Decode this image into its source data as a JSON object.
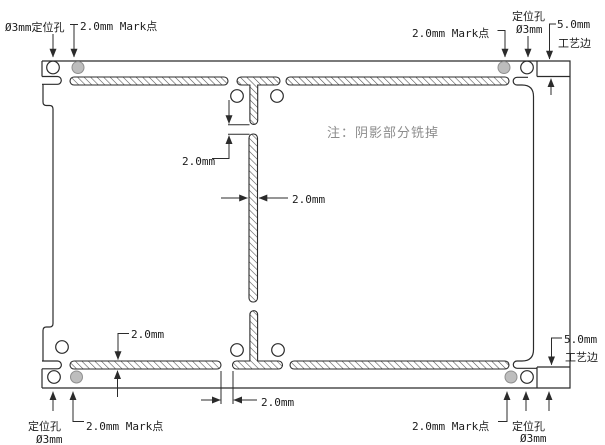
{
  "drawing": {
    "note": "注：阴影部分铣掉",
    "annotations": {
      "top_left_hole": "Ø3mm定位孔",
      "top_left_mark": "2.0mm Mark点",
      "top_right_mark": "2.0mm Mark点",
      "top_right_hole": [
        "定位孔",
        "Ø3mm"
      ],
      "top_right_edge": [
        "5.0mm",
        "工艺边"
      ],
      "bottom_left_hole": [
        "定位孔",
        "Ø3mm"
      ],
      "bottom_left_mark": "2.0mm Mark点",
      "bottom_right_mark": "2.0mm Mark点",
      "bottom_right_hole": [
        "定位孔",
        "Ø3mm"
      ],
      "bottom_right_edge": [
        "5.0mm",
        "工艺边"
      ]
    },
    "dimensions": {
      "bridge_top": "2.0mm",
      "slot_width": "2.0mm",
      "slot_height": "2.0mm",
      "bridge_bottom": "2.0mm"
    },
    "colors": {
      "line": "#2b2b2b",
      "hatch": "#4a4a4a",
      "mark_point_fill": "#bdbdbd",
      "note_text": "#8c8c8c",
      "background": "#ffffff"
    }
  }
}
